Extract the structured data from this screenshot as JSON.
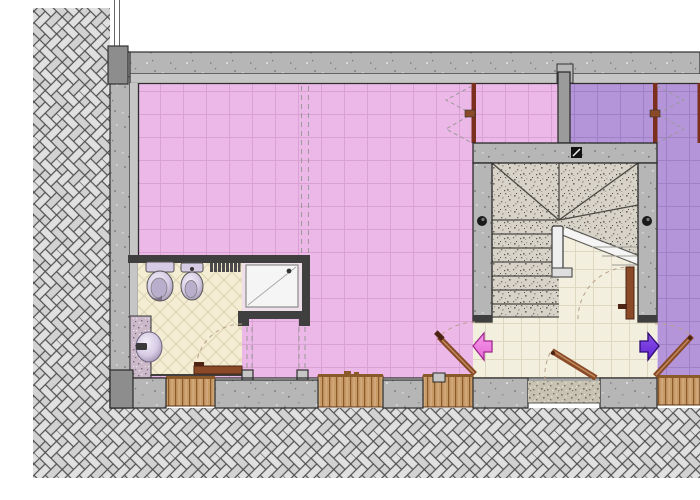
{
  "plan": {
    "type": "architectural-floor-plan",
    "features": [
      "exterior-herringbone-paving",
      "building-shell",
      "pink-apartment-room",
      "pink-annex",
      "purple-annex",
      "purple-apartment-room",
      "bathroom",
      "shower",
      "toilet",
      "bidet",
      "radiator",
      "washbasin",
      "service-pier",
      "stairwell",
      "entrance-hall",
      "doormat",
      "entrance-door",
      "pink-apartment-door",
      "purple-apartment-door",
      "understair-door",
      "bathroom-door",
      "window-jamb-left",
      "window-jamb-right",
      "bottom-windows",
      "direction-arrow-pink",
      "direction-arrow-purple",
      "handrail",
      "stair-cut-line",
      "newel-dots",
      "shaft-symbol"
    ]
  },
  "colors": {
    "page": "#ffffff",
    "pink": "#ecb8e7",
    "pinkGrid": "#d9a2d3",
    "purple": "#b495da",
    "purpleGrid": "#a080c7",
    "cream": "#f3efdf",
    "creamGrid": "#ded8c0",
    "bath": "#f4edd3",
    "bathGrid": "#dbd3b1",
    "nook": "#eedfeb",
    "concrete": "#b6b6b6",
    "concreteDark": "#8d8d8d",
    "bandGray": "#c6c6c6",
    "wallDark": "#2e2e2e",
    "bathWall": "#3f3f3f",
    "wood": "#c89a66",
    "woodLine": "#8a5a2a",
    "door": "#8a4a28",
    "doorHi": "#bf8a5c",
    "doorDark": "#4d2413",
    "paver": "#e0e0e0",
    "paverAlt": "#d2d2d2",
    "paverJoint": "#4f4f4f",
    "granite": "#d8d3c8",
    "graniteDot": "#6e685e",
    "mat": "#c8c2b2",
    "pierTint": "#cbb9c9",
    "arrowPink": "#e668d6",
    "arrowPinkDark": "#a1278f",
    "arrowPurple": "#6223d6",
    "arrowPurpleDark": "#2f0a70",
    "fixture": "#d6cbe4",
    "fixtureDark": "#8f829f",
    "jamb": "#7b2f1d",
    "dash": "#9a9a9a",
    "white": "#f5f5f5"
  }
}
